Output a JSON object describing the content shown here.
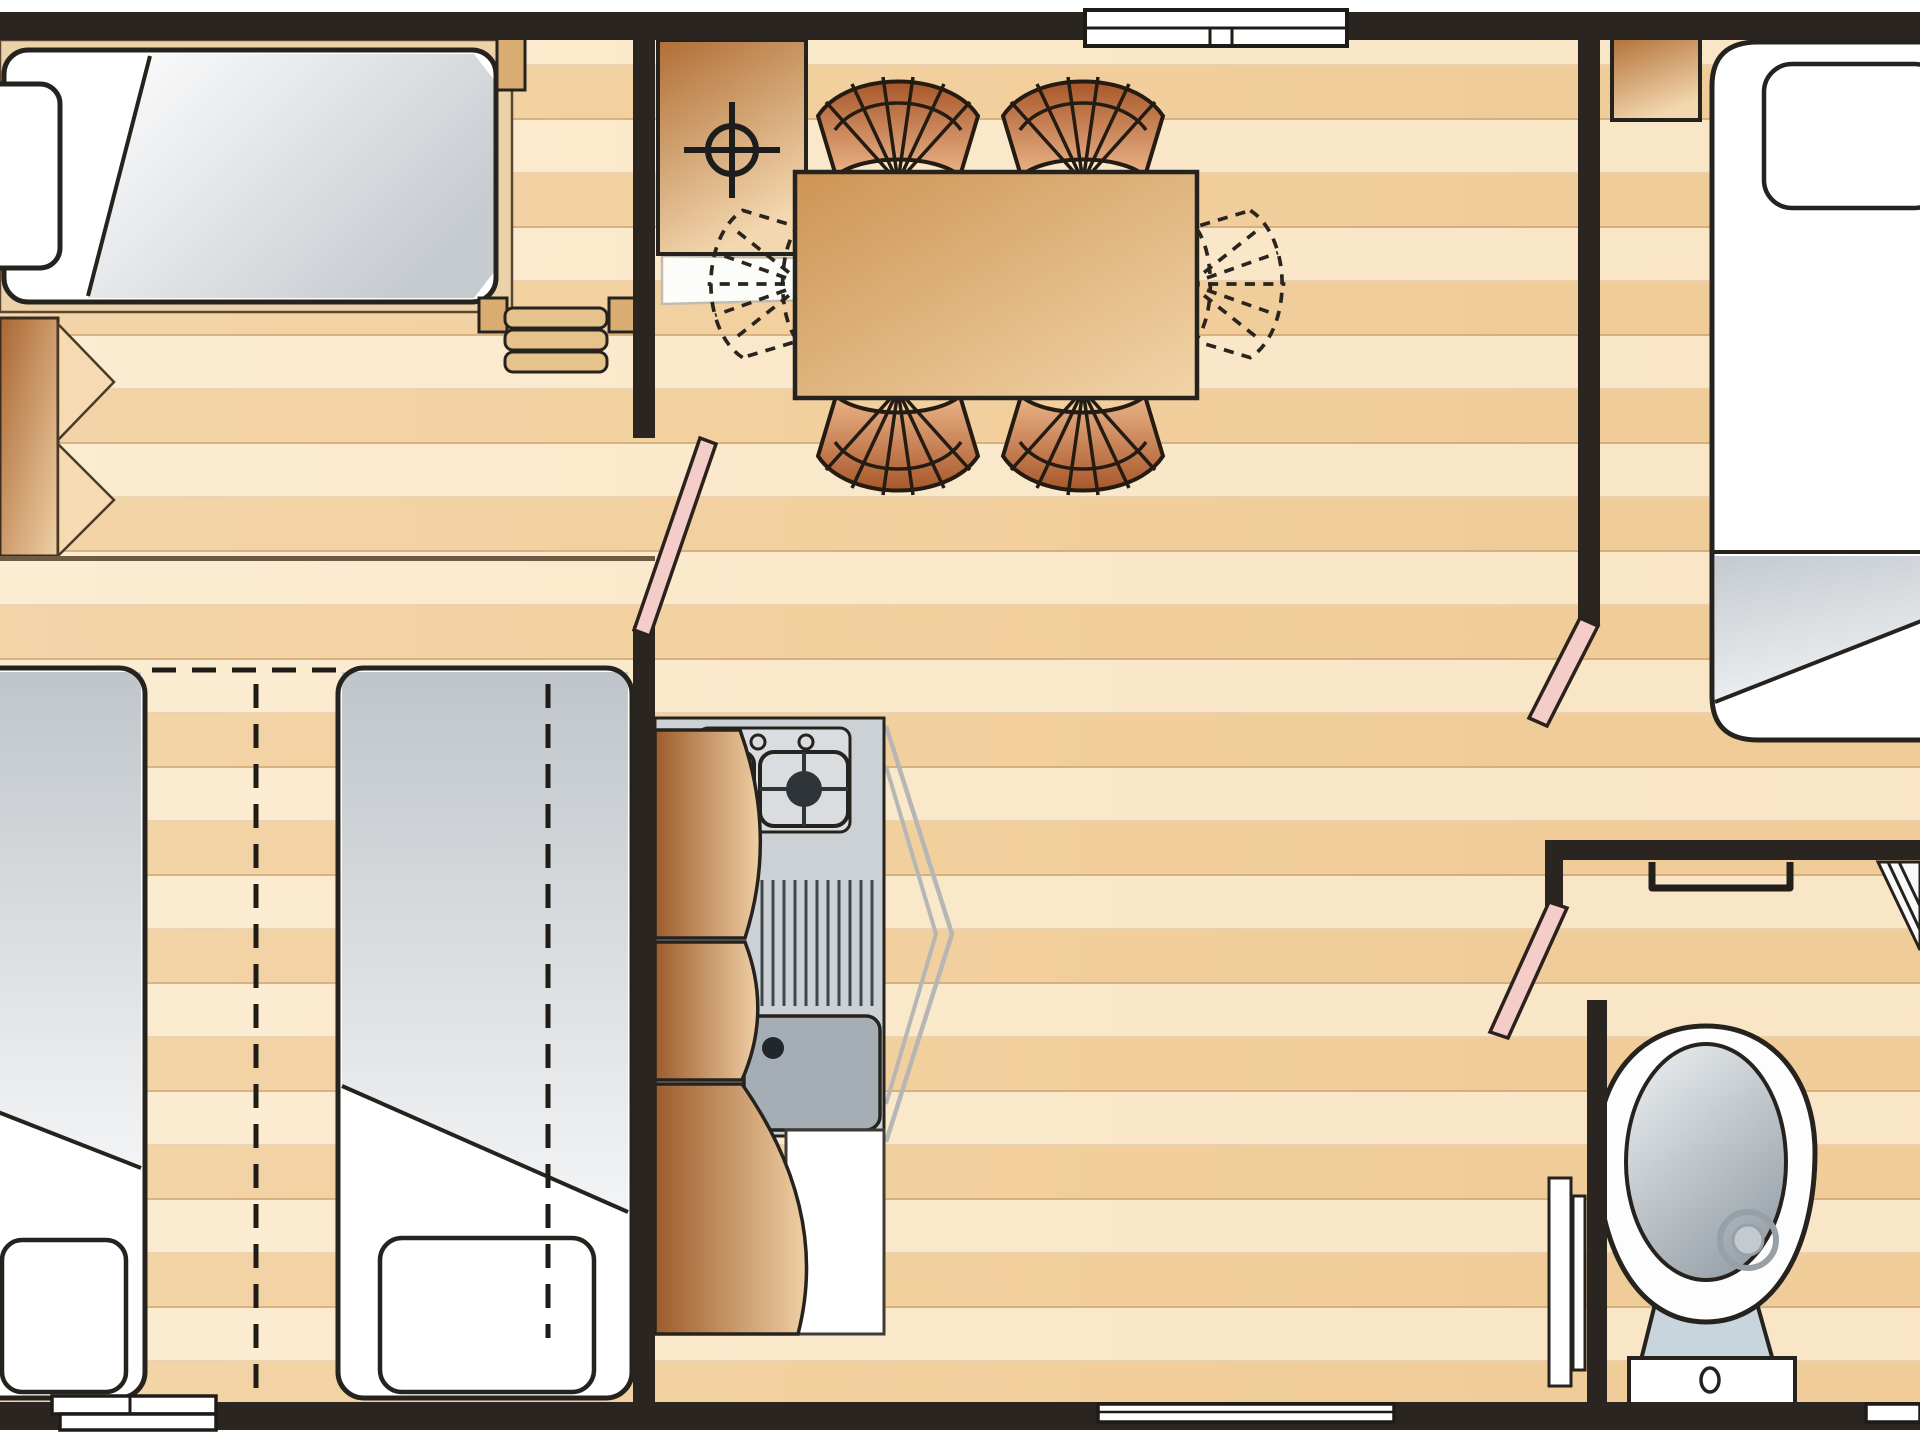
{
  "meta": {
    "type": "floorplan",
    "description": "Top-down floor plan of a mobile home / static caravan with two single-bed rooms, a twin bedroom, open-plan dining-kitchen area, double bedroom and bathroom",
    "text_visible_on_image": "none"
  },
  "palette": {
    "wall": "#2a2521",
    "floor_base": "#f6d9ae",
    "plank_line": "#a47440",
    "wood_dark": "#9c5c2c",
    "wood_light": "#f0cfa4",
    "wicker_dark": "#a8572a",
    "wicker_light": "#eab488",
    "mattress_white": "#ffffff",
    "blanket_gray": "#c6cbd0",
    "counter_gray": "#ccd1d6",
    "sink_gray": "#a6aeb5",
    "door_pink": "#f5cdc8",
    "outline": "#26231f"
  },
  "rooms": [
    {
      "name": "single-bedroom-top-left",
      "furniture": [
        "single-bed",
        "pillow",
        "blanket",
        "bed-steps",
        "wardrobe-with-swing-doors"
      ]
    },
    {
      "name": "twin-bedroom-bottom-left",
      "furniture": [
        "twin-bed-left",
        "twin-bed-right",
        "pillows",
        "slide-together-dashed-marks",
        "window"
      ]
    },
    {
      "name": "living-dining-area",
      "furniture": [
        "dining-table",
        "wicker-chair x4",
        "folding-chair-dashed x2",
        "boiler-cabinet-with-crosshair"
      ]
    },
    {
      "name": "kitchen",
      "furniture": [
        "worktop",
        "gas-hob",
        "drainer",
        "sink-with-tap",
        "curved-cabinet-doors",
        "lower-cabinet",
        "fold-door-outline"
      ]
    },
    {
      "name": "double-bedroom-right",
      "furniture": [
        "double-bed",
        "pillow",
        "blanket",
        "bedside-cabinet"
      ]
    },
    {
      "name": "bathroom",
      "furniture": [
        "toilet-with-cistern",
        "towel-rail",
        "corner-shelf",
        "door-panels"
      ]
    }
  ],
  "openings": {
    "windows": [
      "top-wall-window",
      "bottom-left-window",
      "bottom-middle-window",
      "bottom-right-window"
    ],
    "doors_pink": [
      "twin-bedroom-door",
      "double-bedroom-door",
      "bathroom-door"
    ]
  }
}
